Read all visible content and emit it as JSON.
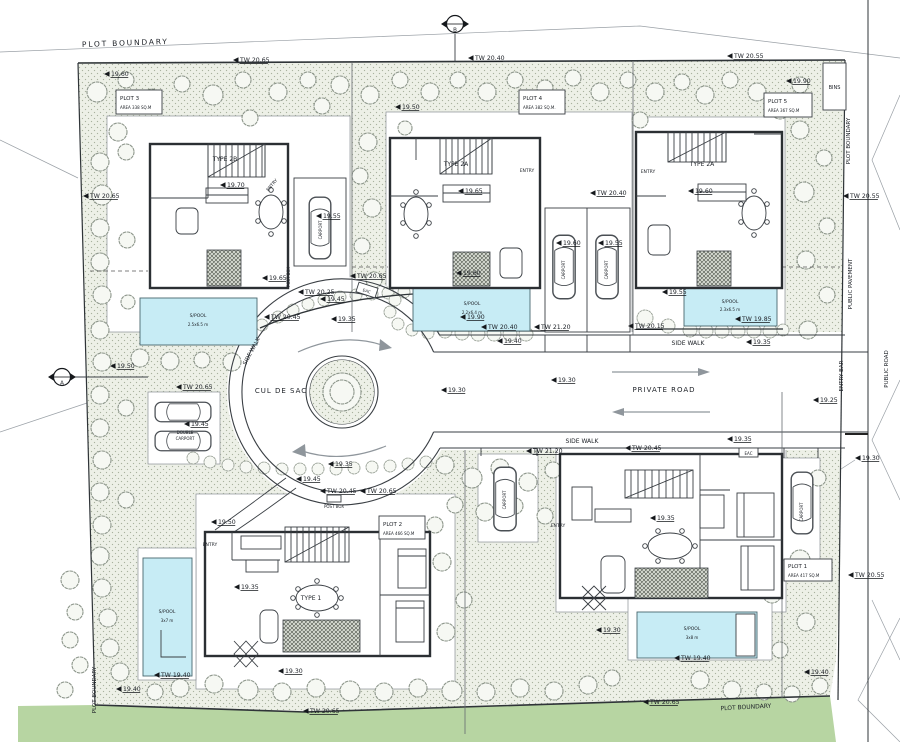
{
  "colors": {
    "paper": "#ffffff",
    "garden": "#edf0e7",
    "garden_dot": "#a9b29f",
    "pool": "#c7ecf5",
    "green_strip": "#b7d5a2",
    "wall": "#2b2f33"
  },
  "boundary": {
    "top": "PLOT BOUNDARY",
    "left_bottom": "PLOT BOUNDARY",
    "bottom": "PLOT BOUNDARY",
    "right": "PLOT BOUNDARY"
  },
  "right_margin": {
    "public_pavement": "PUBLIC PAVEMENT",
    "entry_bar": "ENTRY BAR",
    "public_road": "PUBLIC ROAD",
    "bins": "BINS"
  },
  "roads": {
    "cul_de_sac": "CUL DE SAC",
    "private_road": "PRIVATE ROAD",
    "side_walk_top": "SIDE WALK",
    "side_walk_bottom": "SIDE WALK",
    "side_walk_left": "SIDE WALK"
  },
  "plots": [
    {
      "name": "PLOT 3",
      "area": "AREA 338 SQ.M"
    },
    {
      "name": "PLOT 4",
      "area": "AREA 382 SQ.M."
    },
    {
      "name": "PLOT 5",
      "area": "AREA 367 SQ.M"
    },
    {
      "name": "PLOT 2",
      "area": "AREA 466 SQ.M"
    },
    {
      "name": "PLOT 1",
      "area": "AREA 417 SQ.M"
    }
  ],
  "houses": [
    {
      "type": "TYPE 2B"
    },
    {
      "type": "TYPE 2A"
    },
    {
      "type": "TYPE 2A"
    },
    {
      "type": "TYPE 1"
    }
  ],
  "annotations": {
    "entry": "ENTRY",
    "carport": "CARPORT",
    "double_carport_1": "DOUBLE",
    "double_carport_2": "CARPORT",
    "post_box": "POST BOX",
    "eac": "EAC"
  },
  "pools": [
    {
      "label": "S/POOL",
      "size": "2.5x6.5 m"
    },
    {
      "label": "S/POOL",
      "size": "2.2x6.4 m"
    },
    {
      "label": "S/POOL",
      "size": "2.3x6.5 m"
    },
    {
      "label": "S/POOL",
      "size": "3x7 m"
    },
    {
      "label": "S/POOL",
      "size": "3x8 m"
    }
  ],
  "section_markers": [
    {
      "letter": "B"
    },
    {
      "letter": "A"
    }
  ],
  "markers": [
    {
      "t": "TW 20.65",
      "x": 233,
      "y": 60
    },
    {
      "t": "TW 20.40",
      "x": 468,
      "y": 58
    },
    {
      "t": "TW 20.55",
      "x": 727,
      "y": 56
    },
    {
      "t": "19.60",
      "x": 104,
      "y": 74
    },
    {
      "t": "19.50",
      "x": 395,
      "y": 107
    },
    {
      "t": "19.90",
      "x": 786,
      "y": 81
    },
    {
      "t": "TW 20.65",
      "x": 83,
      "y": 196
    },
    {
      "t": "19.70",
      "x": 220,
      "y": 185
    },
    {
      "t": "19.55",
      "x": 316,
      "y": 216
    },
    {
      "t": "19.65",
      "x": 458,
      "y": 191
    },
    {
      "t": "TW 20.40",
      "x": 590,
      "y": 193
    },
    {
      "t": "19.60",
      "x": 688,
      "y": 191
    },
    {
      "t": "19.60",
      "x": 556,
      "y": 243
    },
    {
      "t": "19.55",
      "x": 598,
      "y": 243
    },
    {
      "t": "19.65",
      "x": 262,
      "y": 278
    },
    {
      "t": "TW 20.65",
      "x": 350,
      "y": 276
    },
    {
      "t": "TW 20.25",
      "x": 298,
      "y": 292
    },
    {
      "t": "19.45",
      "x": 320,
      "y": 299
    },
    {
      "t": "TW 20.45",
      "x": 264,
      "y": 317
    },
    {
      "t": "19.35",
      "x": 331,
      "y": 319
    },
    {
      "t": "19.60",
      "x": 456,
      "y": 273
    },
    {
      "t": "19.90",
      "x": 460,
      "y": 317
    },
    {
      "t": "TW 20.40",
      "x": 481,
      "y": 327
    },
    {
      "t": "TW 21.20",
      "x": 534,
      "y": 327
    },
    {
      "t": "19.40",
      "x": 497,
      "y": 341
    },
    {
      "t": "19.55",
      "x": 662,
      "y": 292
    },
    {
      "t": "TW 20.15",
      "x": 628,
      "y": 326
    },
    {
      "t": "TW 19.85",
      "x": 735,
      "y": 319
    },
    {
      "t": "19.35",
      "x": 746,
      "y": 342
    },
    {
      "t": "19.30",
      "x": 441,
      "y": 390
    },
    {
      "t": "19.30",
      "x": 551,
      "y": 380
    },
    {
      "t": "19.35",
      "x": 328,
      "y": 464
    },
    {
      "t": "19.45",
      "x": 296,
      "y": 479
    },
    {
      "t": "TW 20.45",
      "x": 320,
      "y": 491
    },
    {
      "t": "TW 20.65",
      "x": 360,
      "y": 491
    },
    {
      "t": "19.50",
      "x": 110,
      "y": 366
    },
    {
      "t": "TW 20.65",
      "x": 176,
      "y": 387
    },
    {
      "t": "19.45",
      "x": 184,
      "y": 424
    },
    {
      "t": "19.50",
      "x": 211,
      "y": 522
    },
    {
      "t": "19.35",
      "x": 234,
      "y": 587
    },
    {
      "t": "19.30",
      "x": 278,
      "y": 671
    },
    {
      "t": "TW 19.40",
      "x": 154,
      "y": 675
    },
    {
      "t": "19.40",
      "x": 116,
      "y": 689
    },
    {
      "t": "TW 20.65",
      "x": 303,
      "y": 711
    },
    {
      "t": "19.35",
      "x": 727,
      "y": 439
    },
    {
      "t": "TW 20.45",
      "x": 625,
      "y": 448
    },
    {
      "t": "TW 21.20",
      "x": 526,
      "y": 451
    },
    {
      "t": "19.25",
      "x": 813,
      "y": 400
    },
    {
      "t": "19.30",
      "x": 855,
      "y": 458
    },
    {
      "t": "19.35",
      "x": 650,
      "y": 518
    },
    {
      "t": "TW 20.55",
      "x": 848,
      "y": 575
    },
    {
      "t": "19.30",
      "x": 596,
      "y": 630
    },
    {
      "t": "TW 19.40",
      "x": 674,
      "y": 658
    },
    {
      "t": "19.40",
      "x": 804,
      "y": 672
    },
    {
      "t": "TW 20.65",
      "x": 643,
      "y": 702
    },
    {
      "t": "TW 20.55",
      "x": 843,
      "y": 196
    }
  ],
  "trees": [
    [
      97,
      92,
      10
    ],
    [
      126,
      80,
      8
    ],
    [
      118,
      132,
      9
    ],
    [
      152,
      98,
      9
    ],
    [
      182,
      84,
      8
    ],
    [
      213,
      95,
      10
    ],
    [
      243,
      80,
      8
    ],
    [
      250,
      118,
      8
    ],
    [
      278,
      92,
      9
    ],
    [
      308,
      80,
      8
    ],
    [
      322,
      106,
      8
    ],
    [
      340,
      85,
      9
    ],
    [
      370,
      95,
      9
    ],
    [
      400,
      80,
      8
    ],
    [
      405,
      128,
      7
    ],
    [
      430,
      92,
      9
    ],
    [
      458,
      80,
      8
    ],
    [
      487,
      92,
      9
    ],
    [
      515,
      80,
      8
    ],
    [
      530,
      104,
      8
    ],
    [
      545,
      88,
      8
    ],
    [
      573,
      78,
      8
    ],
    [
      600,
      92,
      9
    ],
    [
      628,
      80,
      8
    ],
    [
      655,
      92,
      9
    ],
    [
      640,
      120,
      8
    ],
    [
      682,
      82,
      8
    ],
    [
      705,
      95,
      9
    ],
    [
      730,
      80,
      8
    ],
    [
      757,
      92,
      9
    ],
    [
      780,
      110,
      9
    ],
    [
      800,
      85,
      8
    ],
    [
      100,
      162,
      9
    ],
    [
      126,
      152,
      8
    ],
    [
      102,
      195,
      10
    ],
    [
      100,
      228,
      9
    ],
    [
      127,
      240,
      8
    ],
    [
      100,
      262,
      9
    ],
    [
      102,
      295,
      9
    ],
    [
      128,
      302,
      7
    ],
    [
      100,
      330,
      9
    ],
    [
      102,
      362,
      9
    ],
    [
      100,
      395,
      9
    ],
    [
      126,
      408,
      8
    ],
    [
      100,
      428,
      9
    ],
    [
      102,
      460,
      9
    ],
    [
      100,
      492,
      9
    ],
    [
      126,
      500,
      8
    ],
    [
      102,
      525,
      9
    ],
    [
      100,
      556,
      9
    ],
    [
      70,
      580,
      9
    ],
    [
      102,
      588,
      9
    ],
    [
      75,
      612,
      8
    ],
    [
      108,
      618,
      9
    ],
    [
      70,
      640,
      8
    ],
    [
      110,
      648,
      9
    ],
    [
      80,
      665,
      8
    ],
    [
      120,
      672,
      9
    ],
    [
      65,
      690,
      8
    ],
    [
      155,
      692,
      8
    ],
    [
      368,
      142,
      9
    ],
    [
      360,
      176,
      8
    ],
    [
      372,
      208,
      9
    ],
    [
      362,
      246,
      8
    ],
    [
      374,
      280,
      8
    ],
    [
      800,
      130,
      9
    ],
    [
      824,
      158,
      8
    ],
    [
      804,
      192,
      10
    ],
    [
      827,
      226,
      8
    ],
    [
      806,
      260,
      9
    ],
    [
      827,
      295,
      8
    ],
    [
      808,
      330,
      9
    ],
    [
      445,
      465,
      9
    ],
    [
      472,
      478,
      10
    ],
    [
      500,
      468,
      9
    ],
    [
      528,
      482,
      9
    ],
    [
      553,
      470,
      8
    ],
    [
      455,
      505,
      8
    ],
    [
      485,
      512,
      9
    ],
    [
      515,
      506,
      8
    ],
    [
      545,
      516,
      8
    ],
    [
      435,
      525,
      8
    ],
    [
      442,
      562,
      9
    ],
    [
      464,
      600,
      8
    ],
    [
      446,
      632,
      9
    ],
    [
      818,
      478,
      8
    ],
    [
      755,
      530,
      7
    ],
    [
      760,
      560,
      8
    ],
    [
      800,
      560,
      10
    ],
    [
      772,
      594,
      9
    ],
    [
      806,
      622,
      9
    ],
    [
      780,
      650,
      8
    ],
    [
      180,
      688,
      9
    ],
    [
      214,
      684,
      9
    ],
    [
      248,
      690,
      10
    ],
    [
      282,
      692,
      9
    ],
    [
      316,
      688,
      9
    ],
    [
      350,
      691,
      10
    ],
    [
      384,
      692,
      9
    ],
    [
      418,
      688,
      9
    ],
    [
      452,
      691,
      10
    ],
    [
      486,
      692,
      9
    ],
    [
      520,
      688,
      9
    ],
    [
      554,
      691,
      9
    ],
    [
      588,
      685,
      9
    ],
    [
      612,
      678,
      8
    ],
    [
      700,
      680,
      9
    ],
    [
      732,
      690,
      9
    ],
    [
      764,
      692,
      8
    ],
    [
      792,
      694,
      8
    ],
    [
      820,
      686,
      8
    ],
    [
      140,
      358,
      9
    ],
    [
      170,
      361,
      9
    ],
    [
      202,
      360,
      8
    ],
    [
      232,
      362,
      9
    ]
  ],
  "bushes": [
    [
      262,
      325,
      6
    ],
    [
      278,
      317,
      6
    ],
    [
      293,
      310,
      6
    ],
    [
      308,
      304,
      6
    ],
    [
      324,
      300,
      6
    ],
    [
      340,
      297,
      6
    ],
    [
      356,
      295,
      6
    ],
    [
      372,
      294,
      6
    ],
    [
      388,
      293,
      6
    ],
    [
      404,
      292,
      6
    ],
    [
      420,
      292,
      6
    ],
    [
      395,
      300,
      6
    ],
    [
      390,
      312,
      6
    ],
    [
      398,
      324,
      6
    ],
    [
      412,
      330,
      6
    ],
    [
      428,
      333,
      6
    ],
    [
      445,
      331,
      7
    ],
    [
      462,
      333,
      7
    ],
    [
      478,
      334,
      7
    ],
    [
      494,
      334,
      7
    ],
    [
      510,
      334,
      7
    ],
    [
      526,
      334,
      7
    ],
    [
      645,
      318,
      8
    ],
    [
      668,
      326,
      7
    ],
    [
      690,
      330,
      7
    ],
    [
      706,
      331,
      7
    ],
    [
      722,
      331,
      7
    ],
    [
      738,
      331,
      7
    ],
    [
      754,
      331,
      7
    ],
    [
      770,
      331,
      7
    ],
    [
      783,
      330,
      6
    ],
    [
      193,
      458,
      6
    ],
    [
      210,
      462,
      6
    ],
    [
      228,
      465,
      6
    ],
    [
      246,
      467,
      6
    ],
    [
      264,
      468,
      6
    ],
    [
      282,
      469,
      6
    ],
    [
      300,
      469,
      6
    ],
    [
      318,
      469,
      6
    ],
    [
      336,
      469,
      6
    ],
    [
      354,
      468,
      6
    ],
    [
      372,
      467,
      6
    ],
    [
      390,
      466,
      6
    ],
    [
      408,
      464,
      6
    ],
    [
      426,
      462,
      6
    ]
  ]
}
